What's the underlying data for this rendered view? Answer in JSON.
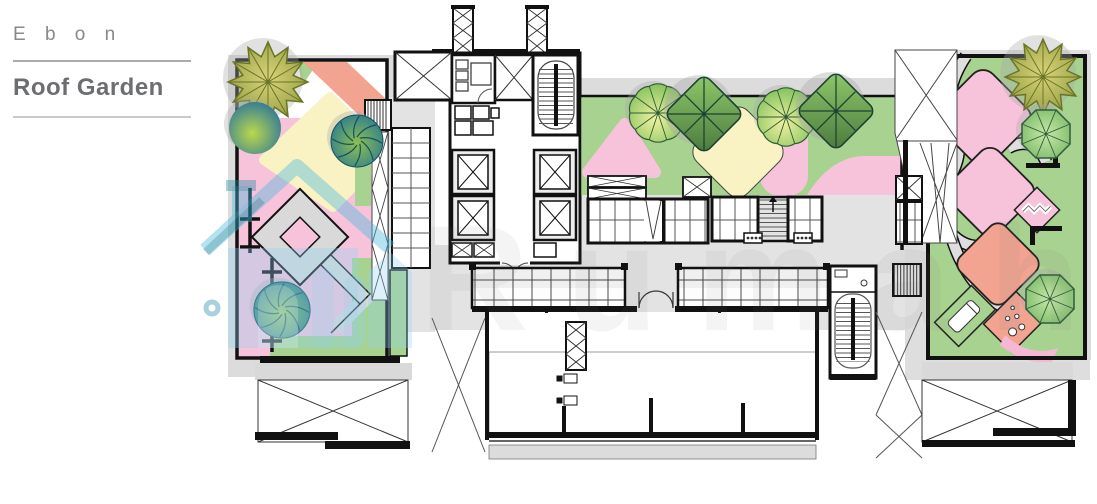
{
  "panel": {
    "project_name": "E b o n",
    "plan_name": "Roof Garden"
  },
  "watermark": {
    "text": "Rumah",
    "icon": "house-logo-icon",
    "color": "#8ed2f2"
  },
  "palette": {
    "lawn_green": "#a8d28f",
    "planting_pink": "#f6c3da",
    "planting_salmon": "#f2a490",
    "planting_yellow": "#f9f3c4",
    "hardscape_gray": "#dcdcdc",
    "roof_gray": "#e3e3e3",
    "wall_black": "#1a1a1a",
    "title_gray": "#6d6e71"
  },
  "plan": {
    "name": "roof-garden-floor-plan",
    "zones": [
      "left roof garden",
      "central service core",
      "central lawn garden",
      "pergola glazing",
      "open roof terrace",
      "right roof garden"
    ],
    "tree_types": [
      "star-canopy-tree",
      "round-gradient-tree",
      "swirl-canopy-tree",
      "scalloped-canopy-tree",
      "diamond-canopy-tree",
      "octagon-canopy-tree"
    ]
  }
}
